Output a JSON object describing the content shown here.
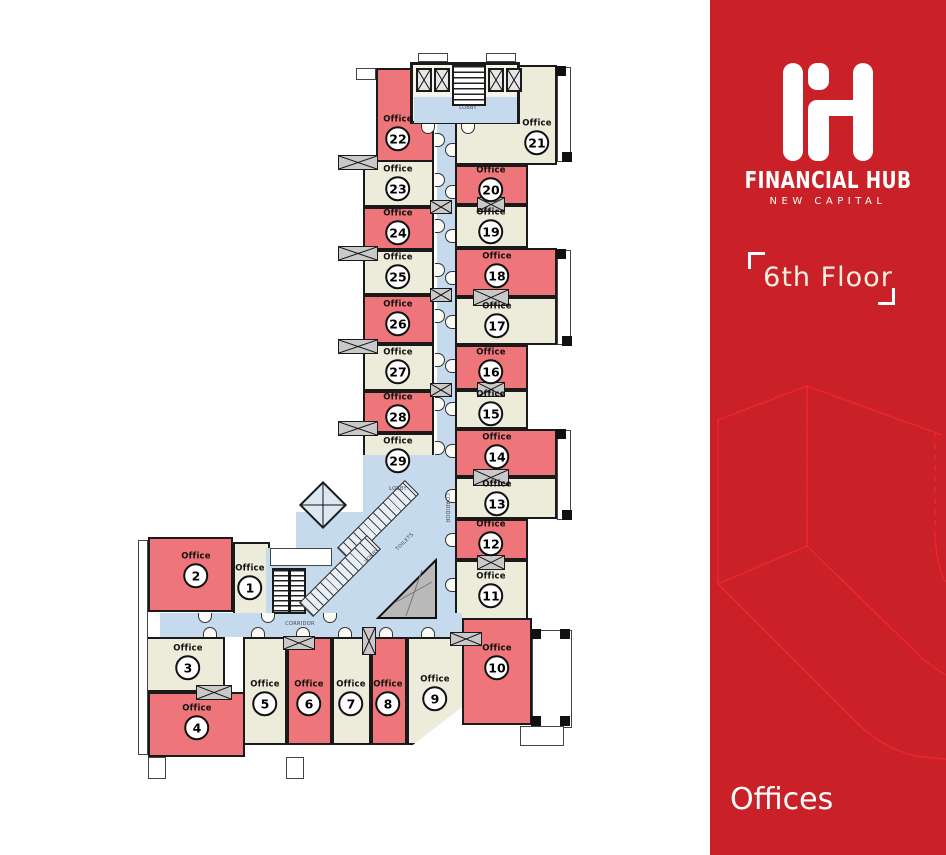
{
  "panel": {
    "background_color": "#ca2027",
    "accent_line_color": "#ef262e",
    "brand_name": "FINANCIAL HUB",
    "brand_subtitle": "NEW CAPITAL",
    "floor_label": "6th Floor",
    "category_label": "Offices"
  },
  "plan": {
    "office_word": "Office",
    "colors": {
      "highlighted_office": "#ee767a",
      "standard_office": "#edebd9",
      "circulation": "#c5daed",
      "wall": "#1a1a1a"
    },
    "core_labels": {
      "lobby": "LOBBY",
      "toilets": "TOILETS",
      "corridor": "CORRIDOR"
    },
    "offices": [
      {
        "number": 1,
        "highlighted": false
      },
      {
        "number": 2,
        "highlighted": true
      },
      {
        "number": 3,
        "highlighted": false
      },
      {
        "number": 4,
        "highlighted": true
      },
      {
        "number": 5,
        "highlighted": false
      },
      {
        "number": 6,
        "highlighted": true
      },
      {
        "number": 7,
        "highlighted": false
      },
      {
        "number": 8,
        "highlighted": true
      },
      {
        "number": 9,
        "highlighted": false
      },
      {
        "number": 10,
        "highlighted": true
      },
      {
        "number": 11,
        "highlighted": false
      },
      {
        "number": 12,
        "highlighted": true
      },
      {
        "number": 13,
        "highlighted": false
      },
      {
        "number": 14,
        "highlighted": true
      },
      {
        "number": 15,
        "highlighted": false
      },
      {
        "number": 16,
        "highlighted": true
      },
      {
        "number": 17,
        "highlighted": false
      },
      {
        "number": 18,
        "highlighted": true
      },
      {
        "number": 19,
        "highlighted": false
      },
      {
        "number": 20,
        "highlighted": true
      },
      {
        "number": 21,
        "highlighted": false
      },
      {
        "number": 22,
        "highlighted": true
      },
      {
        "number": 23,
        "highlighted": false
      },
      {
        "number": 24,
        "highlighted": true
      },
      {
        "number": 25,
        "highlighted": false
      },
      {
        "number": 26,
        "highlighted": true
      },
      {
        "number": 27,
        "highlighted": false
      },
      {
        "number": 28,
        "highlighted": true
      },
      {
        "number": 29,
        "highlighted": false
      }
    ]
  }
}
